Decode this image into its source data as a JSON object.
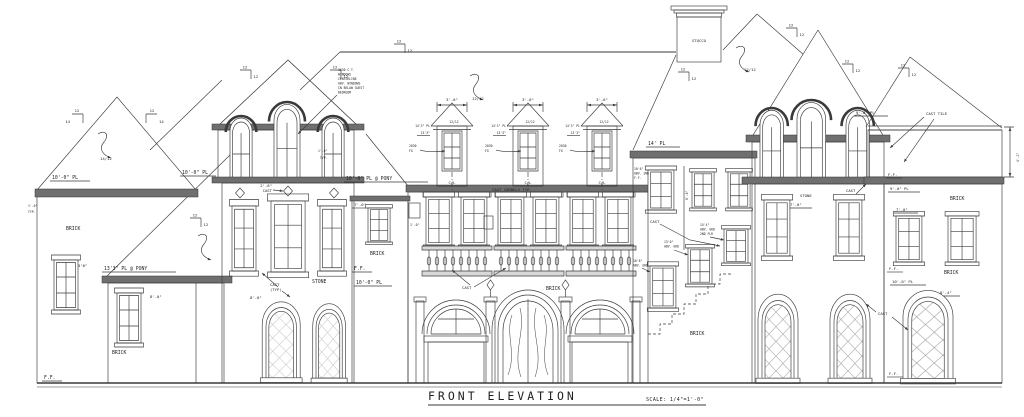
{
  "title": {
    "label": "FRONT ELEVATION",
    "scale": "SCALE: 1/4\"=1'-0\""
  },
  "materials": {
    "brick": "BRICK",
    "stone": "STONE",
    "stucco": "STUCCO",
    "cast": "CAST",
    "cast_typ": "(TYP)",
    "cast_tile": "CAST TILE",
    "cast_corbels": "CAST CORBELS TYP.",
    "cast_2_6": "2'-6\"",
    "cl": "C/L"
  },
  "plates": {
    "pl_10_0": "10'-0\" PL",
    "pl_10_0_pony": "10'-0\" PL @ PONY",
    "pl_13_3_pony": "13'3\" PL @ PONY",
    "pl_14": "14' PL",
    "pl_9_0": "9'-0\" PL",
    "ff": "F.F."
  },
  "dims": {
    "d_3_0": "3'-0\"",
    "d_7_0": "7'-0\"",
    "d_8_0": "8'-0\"",
    "d_8_4": "8'-4\"",
    "d_1_0": "1'-0\"",
    "typ": "TYP.",
    "d_3_6": "3'6\"",
    "d_4_2": "4'-2\"",
    "d_14_3": "14'3\" PL",
    "d_13_3": "13'3\"",
    "d_2030": "2030",
    "fg": "FG"
  },
  "pitch": {
    "p12": "12",
    "p14": "14",
    "r14_12": "14/12",
    "r12_12": "12/12"
  },
  "notes": {
    "window_note": [
      "3630 C.T.",
      "WINDOWS",
      "CENTERLINE",
      "ABV. WINDOWS",
      "IN BELOW GUEST",
      "BEDROOM"
    ],
    "abv_10_6": [
      "10'6\"",
      "ABV. 2ND",
      "F.F."
    ],
    "abv_15_4": [
      "15'4\"",
      "ABV. GRD",
      "2ND FLR"
    ],
    "abv_13_0": [
      "13'0\"",
      "ABV. GRD"
    ],
    "abv_10_8": [
      "10'8\"",
      "ABV. GRD"
    ]
  },
  "colors": {
    "ink": "#3a3a3a",
    "hatch": "#c9c9c9",
    "paper": "#ffffff"
  }
}
